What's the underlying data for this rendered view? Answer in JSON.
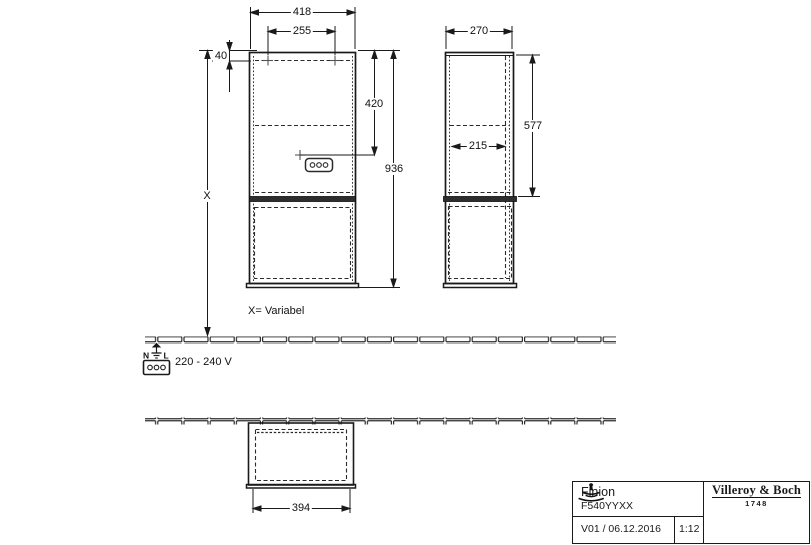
{
  "colors": {
    "line": "#1a1a1a",
    "background": "#ffffff",
    "divider_fill": "#2e2e2e"
  },
  "front_view": {
    "width": "418",
    "hole_spacing": "255",
    "hole_offset": "40",
    "socket_height": "420",
    "cabinet_height": "936",
    "total_height": "X"
  },
  "side_view": {
    "depth": "270",
    "upper_height": "577",
    "inner_depth": "215"
  },
  "bottom_view": {
    "opening_width": "394"
  },
  "notes": {
    "variable_height": "X= Variabel",
    "voltage": "220 - 240 V",
    "neutral_label": "N",
    "line_label": "L"
  },
  "title_block": {
    "product_name": "Finion",
    "article_number": "F540YYXX",
    "version_date": "V01 / 06.12.2016",
    "scale": "1:12",
    "brand_name": "Villeroy & Boch",
    "brand_year": "1748"
  }
}
